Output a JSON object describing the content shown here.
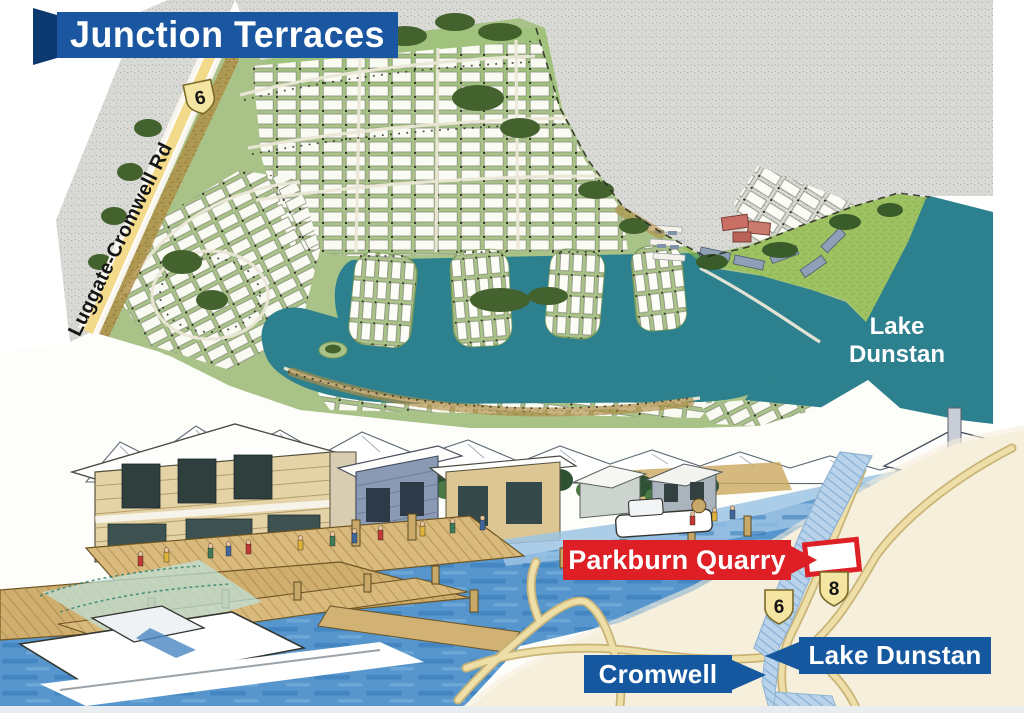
{
  "banner": {
    "title": "Junction Terraces"
  },
  "plan": {
    "road_label": "Luggate-Cromwell Rd",
    "road_shield": "6",
    "lake_label_line1": "Lake",
    "lake_label_line2": "Dunstan"
  },
  "inset": {
    "quarry_label": "Parkburn Quarry",
    "shield_west": "6",
    "shield_east": "8",
    "lake_label": "Lake Dunstan",
    "town_label": "Cromwell"
  },
  "colors": {
    "banner-blue": "#1a57a0",
    "banner-fold": "#0c3a70",
    "label-blue": "#15589f",
    "quarry-red": "#de1f26",
    "water-teal": "#2d818e",
    "land-green": "#a9c287",
    "gravel-gray": "#d9dad6",
    "road-yellow": "#f3da8a",
    "street-tan": "#b08e45",
    "tree-green": "#44622e",
    "shore-green": "#95c247",
    "inset-cream": "#f6efdb",
    "inset-road-fill": "#eedfa8",
    "inset-road-edge": "#c9b477",
    "river-blue": "#b9d4ea",
    "scene-water": "#5796cc",
    "timber-deck": "#d9ba7c",
    "shield-yellow": "#f4e5a3"
  }
}
